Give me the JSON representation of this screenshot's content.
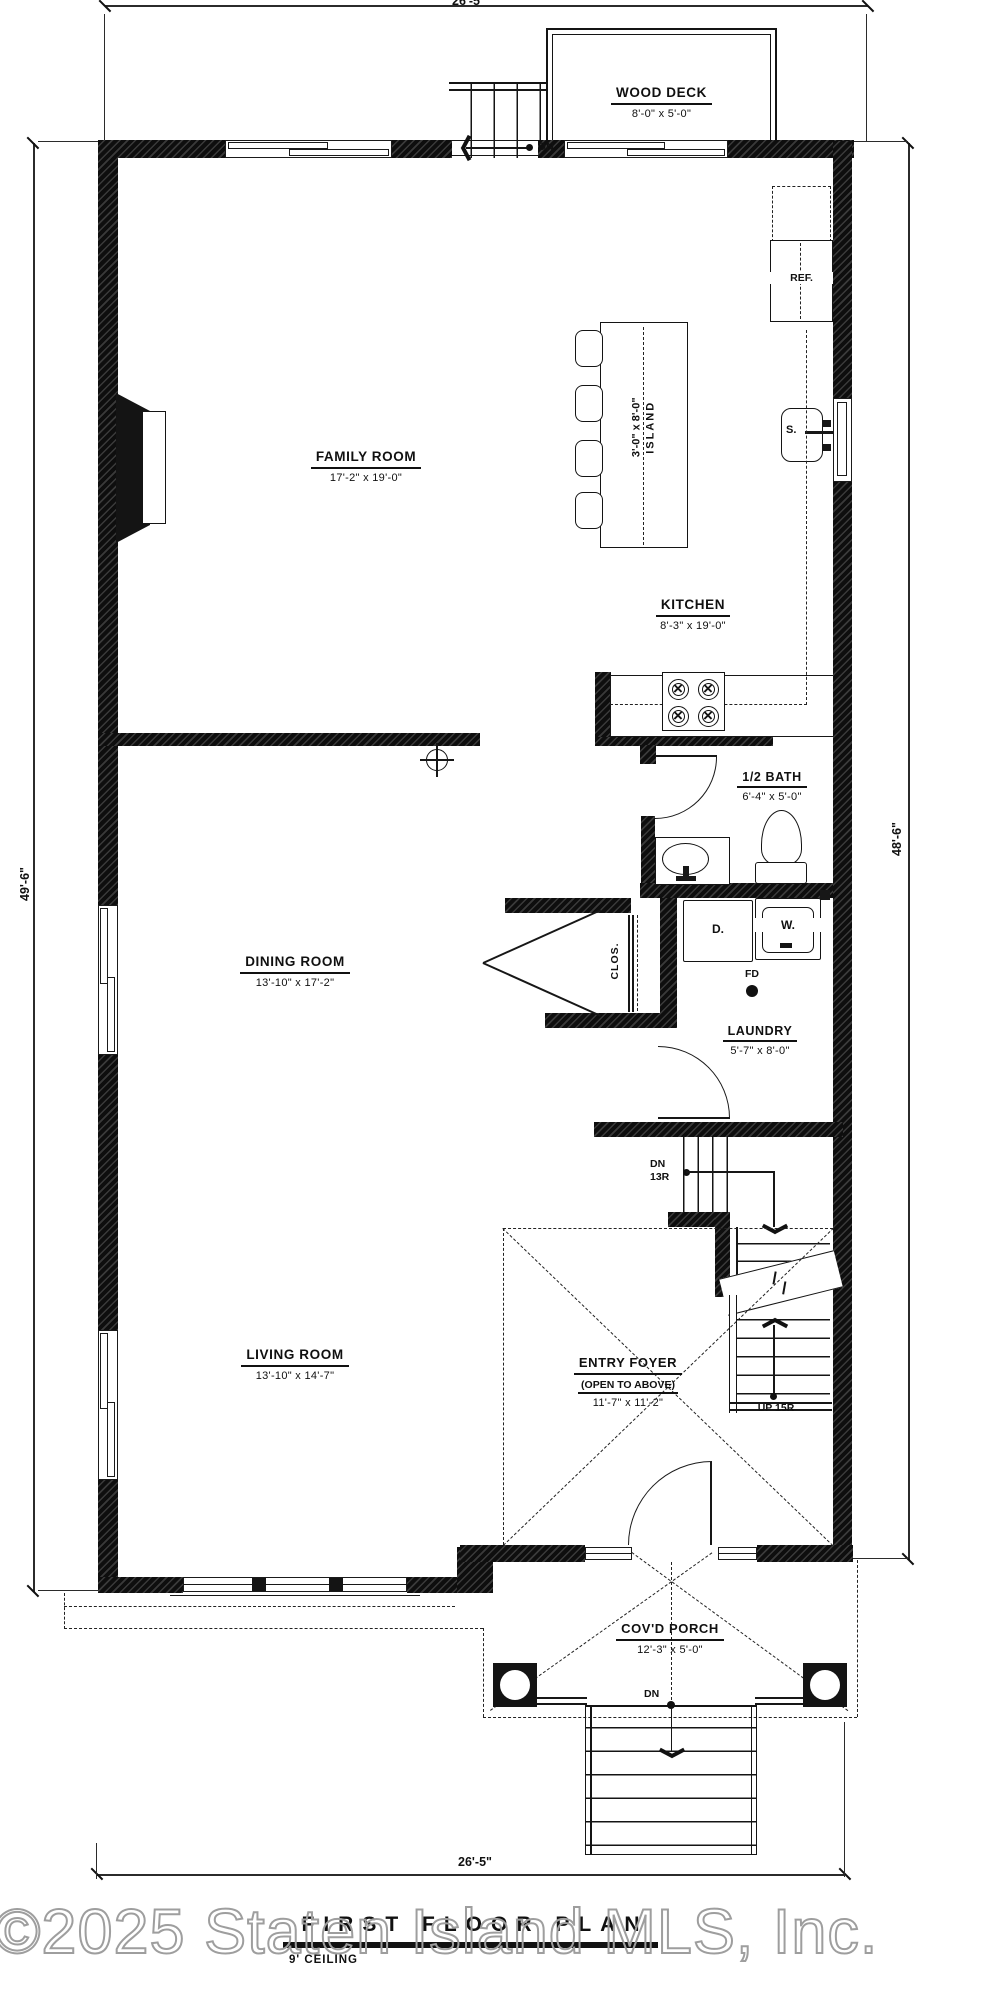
{
  "page": {
    "type": "architectural first floor plan drawing"
  },
  "title_block": {
    "title": "FIRST FLOOR PLAN",
    "ceiling": "9' CEILING"
  },
  "watermark": "©2025 Staten Island MLS, Inc.",
  "dimensions": {
    "top": "26'-5\"",
    "bottom": "26'-5\"",
    "left_side": "49'-6\"",
    "right_side": "48'-6\""
  },
  "rooms": {
    "wood_deck": {
      "name": "WOOD DECK",
      "dims": "8'-0\" x 5'-0\""
    },
    "family_room": {
      "name": "FAMILY ROOM",
      "dims": "17'-2\" x 19'-0\""
    },
    "kitchen": {
      "name": "KITCHEN",
      "dims": "8'-3\" x 19'-0\""
    },
    "island": {
      "name": "ISLAND",
      "dims": "3'-0\" x 8'-0\""
    },
    "half_bath": {
      "name": "1/2 BATH",
      "dims": "6'-4\" x 5'-0\""
    },
    "dining_room": {
      "name": "DINING ROOM",
      "dims": "13'-10\" x 17'-2\""
    },
    "laundry": {
      "name": "LAUNDRY",
      "dims": "5'-7\" x 8'-0\""
    },
    "closet": {
      "name": "CLOS."
    },
    "living_room": {
      "name": "LIVING ROOM",
      "dims": "13'-10\" x 14'-7\""
    },
    "entry_foyer": {
      "name": "ENTRY FOYER",
      "note": "(OPEN TO ABOVE)",
      "dims": "11'-7\" x 11'-2\""
    },
    "covered_porch": {
      "name": "COV'D PORCH",
      "dims": "12'-3\" x 5'-0\""
    }
  },
  "fixtures": {
    "refrigerator": "REF.",
    "kitchen_sink": "S.",
    "dryer": "D.",
    "washer": "W.",
    "floor_drain": "FD"
  },
  "stairs": {
    "deck_dn": "DN",
    "basement_dn": "DN",
    "basement_risers": "13R",
    "up_label": "UP 15R",
    "porch_dn": "DN"
  },
  "colors": {
    "wall": "#141414",
    "line": "#1a1a1a",
    "watermark_outline": "#9e9e9e"
  }
}
